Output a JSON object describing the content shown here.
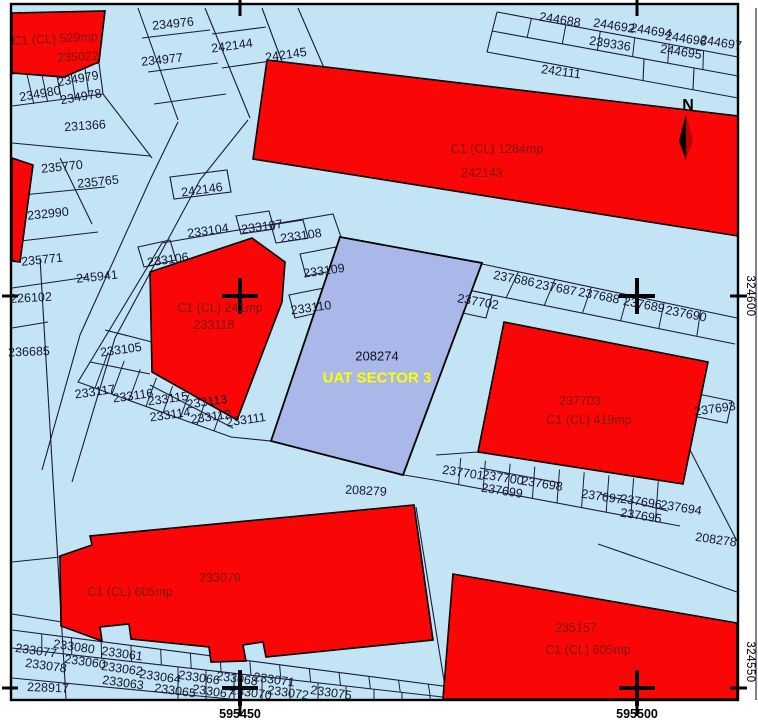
{
  "colors": {
    "background": "#ffffff",
    "land": "#c2e4f4",
    "parcel_red": "#fa0606",
    "uat_blue": "#a9b7e9",
    "line": "#1b1b38",
    "frame": "#000000",
    "num": "#16162e",
    "redtext": "#7e1404",
    "uattext": "#ffff00"
  },
  "north": {
    "label": "N"
  },
  "uat_parcel": {
    "number": "208274",
    "name": "UAT SECTOR 3"
  },
  "grid": {
    "right_labels": [
      "324600",
      "324550"
    ],
    "bottom_labels": [
      "595450",
      "595500"
    ]
  },
  "labels": [
    {
      "t": "C1 (CL) 529mp",
      "x": 55,
      "y": 39,
      "r": -3,
      "c": "red"
    },
    {
      "t": "235022",
      "x": 78,
      "y": 57,
      "r": -3,
      "c": "red"
    },
    {
      "t": "234976",
      "x": 173,
      "y": 24,
      "r": -6
    },
    {
      "t": "242144",
      "x": 232,
      "y": 46,
      "r": -8
    },
    {
      "t": "242145",
      "x": 286,
      "y": 55,
      "r": -8
    },
    {
      "t": "234977",
      "x": 162,
      "y": 60,
      "r": -6
    },
    {
      "t": "234980",
      "x": 40,
      "y": 94,
      "r": -10
    },
    {
      "t": "234979",
      "x": 78,
      "y": 79,
      "r": -10
    },
    {
      "t": "234978",
      "x": 81,
      "y": 97,
      "r": -10
    },
    {
      "t": "231366",
      "x": 85,
      "y": 126,
      "r": -4
    },
    {
      "t": "235770",
      "x": 62,
      "y": 167,
      "r": -6
    },
    {
      "t": "235765",
      "x": 98,
      "y": 182,
      "r": -6
    },
    {
      "t": "232990",
      "x": 48,
      "y": 214,
      "r": -6
    },
    {
      "t": "235771",
      "x": 42,
      "y": 260,
      "r": -6
    },
    {
      "t": "245941",
      "x": 97,
      "y": 277,
      "r": -6
    },
    {
      "t": "226102",
      "x": 31,
      "y": 298,
      "r": -3
    },
    {
      "t": "236685",
      "x": 29,
      "y": 352,
      "r": -2
    },
    {
      "t": "242146",
      "x": 202,
      "y": 190,
      "r": -8
    },
    {
      "t": "244688",
      "x": 560,
      "y": 20,
      "r": 9
    },
    {
      "t": "244692",
      "x": 614,
      "y": 26,
      "r": 9
    },
    {
      "t": "244694",
      "x": 651,
      "y": 31,
      "r": 9
    },
    {
      "t": "244696",
      "x": 686,
      "y": 39,
      "r": 9
    },
    {
      "t": "244697",
      "x": 721,
      "y": 43,
      "r": 9
    },
    {
      "t": "239336",
      "x": 610,
      "y": 44,
      "r": 9
    },
    {
      "t": "244695",
      "x": 681,
      "y": 52,
      "r": 9
    },
    {
      "t": "242111",
      "x": 561,
      "y": 72,
      "r": 8
    },
    {
      "t": "C1 (CL) 1284mp",
      "x": 497,
      "y": 149,
      "r": 0,
      "c": "red"
    },
    {
      "t": "242143",
      "x": 482,
      "y": 173,
      "r": 0,
      "c": "red"
    },
    {
      "t": "233104",
      "x": 208,
      "y": 231,
      "r": -8
    },
    {
      "t": "233107",
      "x": 262,
      "y": 227,
      "r": -8
    },
    {
      "t": "233108",
      "x": 301,
      "y": 236,
      "r": -8
    },
    {
      "t": "233106",
      "x": 168,
      "y": 260,
      "r": -8
    },
    {
      "t": "233109",
      "x": 324,
      "y": 271,
      "r": -8
    },
    {
      "t": "233110",
      "x": 311,
      "y": 308,
      "r": -8
    },
    {
      "t": "C1 (CL) 241mp",
      "x": 220,
      "y": 308,
      "r": 0,
      "c": "red"
    },
    {
      "t": "233118",
      "x": 214,
      "y": 325,
      "r": 0,
      "c": "red"
    },
    {
      "t": "233105",
      "x": 121,
      "y": 350,
      "r": -8
    },
    {
      "t": "233117",
      "x": 95,
      "y": 392,
      "r": -8
    },
    {
      "t": "233116",
      "x": 133,
      "y": 396,
      "r": -8
    },
    {
      "t": "233115",
      "x": 168,
      "y": 399,
      "r": -8
    },
    {
      "t": "233113",
      "x": 207,
      "y": 402,
      "r": -8
    },
    {
      "t": "233114",
      "x": 170,
      "y": 415,
      "r": -8
    },
    {
      "t": "233112",
      "x": 211,
      "y": 417,
      "r": -8
    },
    {
      "t": "233111",
      "x": 246,
      "y": 420,
      "r": -8
    },
    {
      "t": "208274",
      "x": 377,
      "y": 356,
      "r": 0,
      "c": "uatnum"
    },
    {
      "t": "UAT SECTOR 3",
      "x": 377,
      "y": 378,
      "r": 0,
      "c": "uatname"
    },
    {
      "t": "237702",
      "x": 478,
      "y": 302,
      "r": 10
    },
    {
      "t": "237686",
      "x": 514,
      "y": 279,
      "r": 11
    },
    {
      "t": "237687",
      "x": 556,
      "y": 288,
      "r": 11
    },
    {
      "t": "237688",
      "x": 599,
      "y": 296,
      "r": 11
    },
    {
      "t": "237689",
      "x": 644,
      "y": 305,
      "r": 11
    },
    {
      "t": "237690",
      "x": 686,
      "y": 314,
      "r": 11
    },
    {
      "t": "237703",
      "x": 580,
      "y": 401,
      "r": 0,
      "c": "red"
    },
    {
      "t": "C1 (CL) 419mp",
      "x": 589,
      "y": 420,
      "r": 0,
      "c": "red"
    },
    {
      "t": "237693",
      "x": 715,
      "y": 409,
      "r": -8
    },
    {
      "t": "208279",
      "x": 366,
      "y": 491,
      "r": 3
    },
    {
      "t": "237701",
      "x": 463,
      "y": 473,
      "r": 9
    },
    {
      "t": "237700",
      "x": 503,
      "y": 478,
      "r": 9
    },
    {
      "t": "237699",
      "x": 502,
      "y": 491,
      "r": 9
    },
    {
      "t": "237698",
      "x": 542,
      "y": 484,
      "r": 9
    },
    {
      "t": "237697",
      "x": 602,
      "y": 497,
      "r": 9
    },
    {
      "t": "237696",
      "x": 641,
      "y": 502,
      "r": 9
    },
    {
      "t": "237695",
      "x": 641,
      "y": 516,
      "r": 9
    },
    {
      "t": "237694",
      "x": 681,
      "y": 508,
      "r": 9
    },
    {
      "t": "208278",
      "x": 716,
      "y": 540,
      "r": 8
    },
    {
      "t": "233079",
      "x": 220,
      "y": 578,
      "r": 0,
      "c": "red"
    },
    {
      "t": "C1 (CL) 605mp",
      "x": 130,
      "y": 592,
      "r": 0,
      "c": "red"
    },
    {
      "t": "233077",
      "x": 36,
      "y": 651,
      "r": 8
    },
    {
      "t": "233080",
      "x": 74,
      "y": 647,
      "r": 8
    },
    {
      "t": "233078",
      "x": 46,
      "y": 666,
      "r": 8
    },
    {
      "t": "233060",
      "x": 85,
      "y": 662,
      "r": 8
    },
    {
      "t": "233061",
      "x": 122,
      "y": 654,
      "r": 8
    },
    {
      "t": "233062",
      "x": 122,
      "y": 669,
      "r": 8
    },
    {
      "t": "233063",
      "x": 123,
      "y": 683,
      "r": 8
    },
    {
      "t": "228917",
      "x": 48,
      "y": 688,
      "r": 2
    },
    {
      "t": "233064",
      "x": 160,
      "y": 677,
      "r": 8
    },
    {
      "t": "233066",
      "x": 199,
      "y": 678,
      "r": 8
    },
    {
      "t": "233068",
      "x": 237,
      "y": 679,
      "r": 8
    },
    {
      "t": "233071",
      "x": 274,
      "y": 680,
      "r": 8
    },
    {
      "t": "233065",
      "x": 175,
      "y": 691,
      "r": 8
    },
    {
      "t": "233067",
      "x": 213,
      "y": 692,
      "r": 8
    },
    {
      "t": "233070",
      "x": 251,
      "y": 693,
      "r": 8
    },
    {
      "t": "233072",
      "x": 288,
      "y": 693,
      "r": 8
    },
    {
      "t": "233075",
      "x": 331,
      "y": 693,
      "r": 8
    },
    {
      "t": "235157",
      "x": 576,
      "y": 628,
      "r": 0,
      "c": "red"
    },
    {
      "t": "C1 (CL) 605mp",
      "x": 588,
      "y": 650,
      "r": 0,
      "c": "red"
    },
    {
      "t": "324600",
      "x": 749,
      "y": 296,
      "r": 0,
      "c": "coordv"
    },
    {
      "t": "324550",
      "x": 749,
      "y": 662,
      "r": 0,
      "c": "coordv"
    },
    {
      "t": "595450",
      "x": 240,
      "y": 714,
      "r": 0,
      "c": "coordb"
    },
    {
      "t": "595500",
      "x": 637,
      "y": 714,
      "r": 0,
      "c": "coordb"
    }
  ]
}
